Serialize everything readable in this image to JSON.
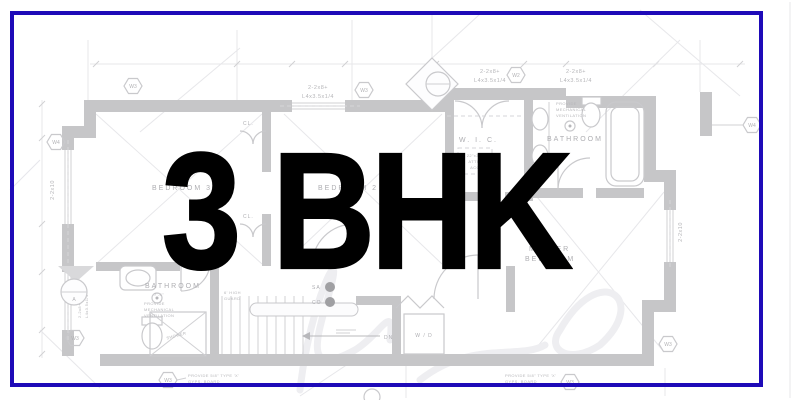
{
  "card": {
    "title": "3 BHK",
    "title_color": "#000000",
    "accent_border_color": "#1E0AB8",
    "background": "#FFFFFF"
  },
  "floor_plan": {
    "ink_color": "#C6C6C8",
    "rooms": {
      "bedroom3": "BEDROOM 3",
      "bedroom2": "BEDROOM 2",
      "wic": "W. I. C.",
      "bathroom_upper": "BATHROOM",
      "bathroom_lower": "BATHROOM",
      "master_line1": "MASTER",
      "master_line2": "BEDROOM",
      "closet1": "CL.",
      "closet2": "CL.",
      "shower": "SHOWER",
      "washer_dryer": "W / D",
      "stairs_down": "DN"
    },
    "devices": {
      "smoke_alarm": "SA",
      "carbon_monoxide": "CO"
    },
    "notes": {
      "vent": [
        "PROVIDE",
        "MECHANICAL",
        "VENTILATION"
      ],
      "gyps": [
        "PROVIDE 5/8\" TYPE 'X'",
        "GYPS. BOARD"
      ],
      "attic": [
        "22\"x30\"",
        "ATTIC",
        "ACC"
      ],
      "guard": [
        "6' HIGH",
        "GUARD"
      ],
      "bath_dim": "7'-4\"",
      "lumber": [
        "2-2x8+",
        "L4x3.5x1/4"
      ],
      "joist": "2-2x10"
    },
    "wall_tags": {
      "w2": "W2",
      "w3": "W3",
      "w4": "W4"
    },
    "section_marker": "A"
  }
}
